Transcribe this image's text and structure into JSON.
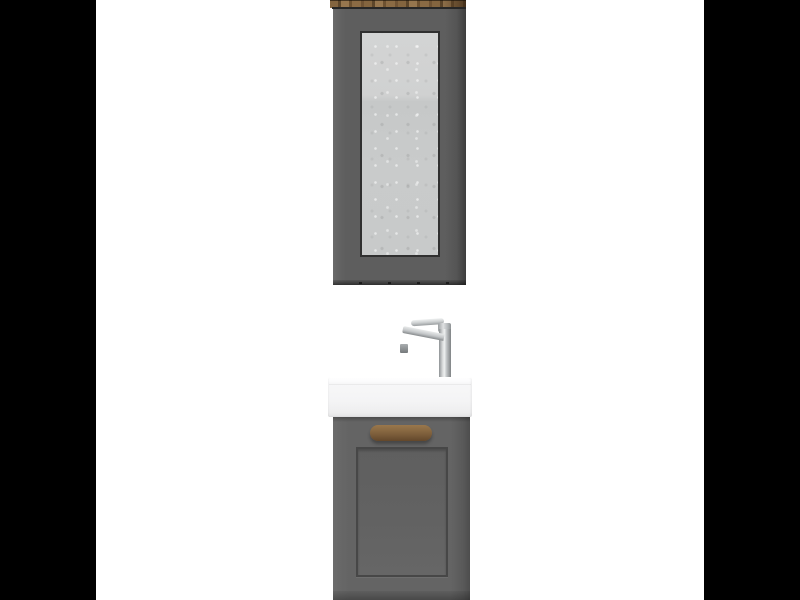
{
  "meta": {
    "scene": "bathroom-furniture-product-photo",
    "objects": [
      "mirror-cabinet",
      "wood-top-trim",
      "mirror-glass",
      "chrome-faucet",
      "ceramic-washbasin",
      "vanity-cabinet",
      "wooden-door-handle",
      "recessed-door-panel"
    ]
  },
  "colors": {
    "page-bg": "#ffffff",
    "letterbox": "#000000",
    "cabinet-gray": "#5e5e5e",
    "cabinet-edge": "#262626",
    "mirror-frame": "#303030",
    "mirror-glass-light": "#d3d4d4",
    "mirror-glass": "#c9cbcb",
    "wood-light": "#96764e",
    "wood-mid": "#84653f",
    "wood-dark": "#5d462a",
    "chrome-light": "#eff1f1",
    "chrome-mid": "#c3c6c8",
    "chrome-dark": "#85898b",
    "ceramic-top": "#ffffff",
    "ceramic-front": "#f4f4f5",
    "ceramic-bottom": "#e3e3e4",
    "vanity-gray": "#646464",
    "vanity-gray-dark": "#4d4d4d",
    "panel-groove": "#474747",
    "handle-wood-light": "#9a774c",
    "handle-wood-dark": "#63472b"
  }
}
